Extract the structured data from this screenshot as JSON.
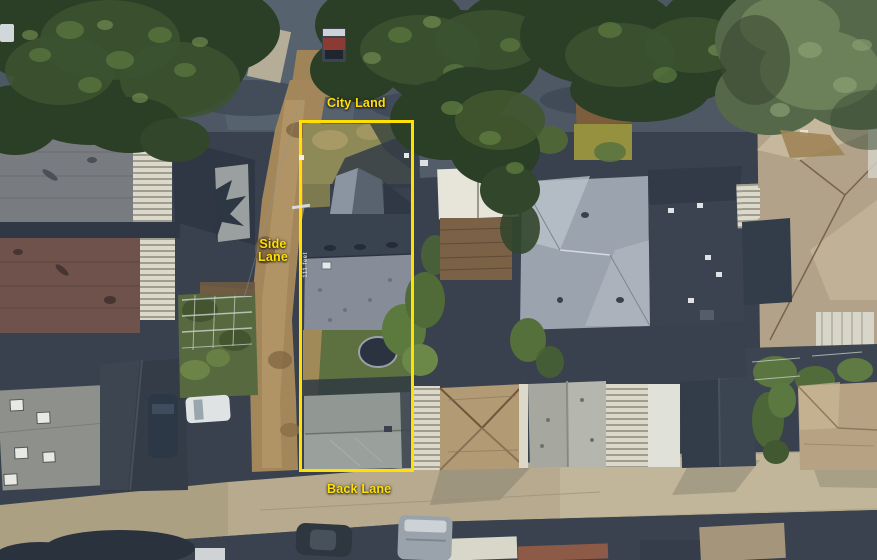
{
  "annotations": {
    "accent_color": "#ffe000",
    "city_land": "City Land",
    "side_lane": {
      "line1": "Side",
      "line2": "Lane"
    },
    "back_lane": "Back Lane",
    "lot_depth_marker": "111 feet"
  },
  "scene": {
    "type": "aerial-satellite-photo",
    "palette": {
      "shadow_navy": "#38414d",
      "asphalt": "#4e5864",
      "dirt_lane": "#a3875a",
      "paved_lane": "#b7aa8e",
      "grass": "#5c7040",
      "tree_dark": "#2b3e26",
      "tree_light": "#55684a",
      "lot_roof_dark": "#39424f",
      "lot_roof_light": "#868d98",
      "garage_roof": "#9aa09b"
    }
  }
}
